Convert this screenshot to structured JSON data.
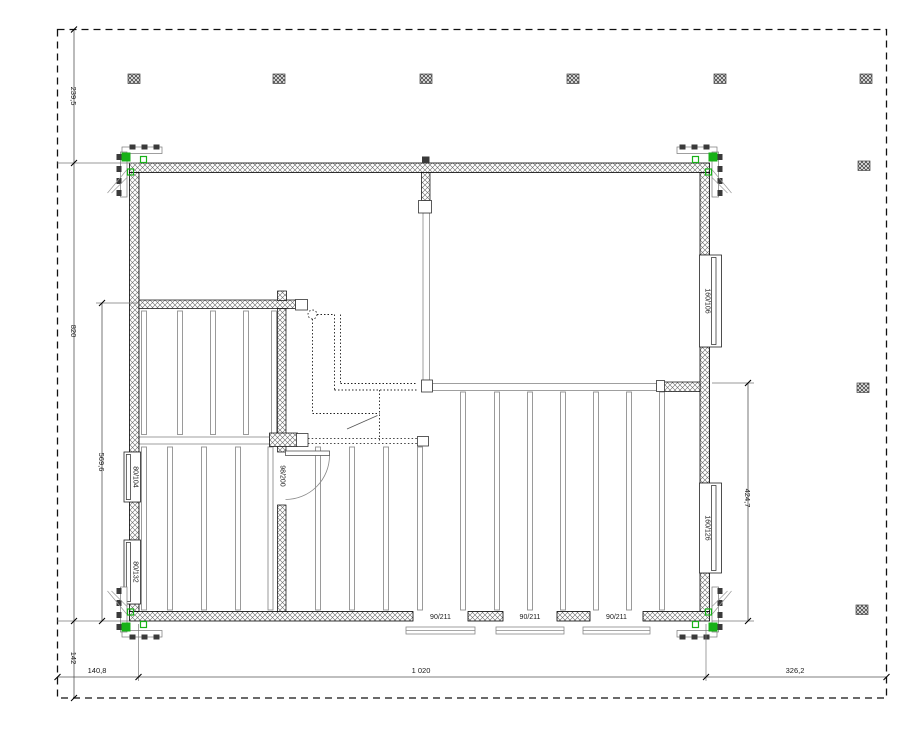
{
  "floor_plan": {
    "dimensions": {
      "top_left_vertical": "239,5",
      "left_height": "820",
      "left_inner_height": "569,6",
      "bottom_left_vertical": "142",
      "bottom_left": "140,8",
      "bottom_center": "1 020",
      "bottom_right": "326,2",
      "right_inner_height": "424,7"
    },
    "windows": {
      "left": [
        "80/104",
        "80/132"
      ],
      "right": [
        "160/106",
        "160/126"
      ]
    },
    "doors": {
      "bottom": [
        "90/211",
        "90/211",
        "90/211"
      ],
      "interior": "98/200"
    },
    "colors": {
      "corner_marker_green": "#17b117",
      "line_black": "#000000",
      "beam_gray": "#8a8a8a"
    }
  }
}
